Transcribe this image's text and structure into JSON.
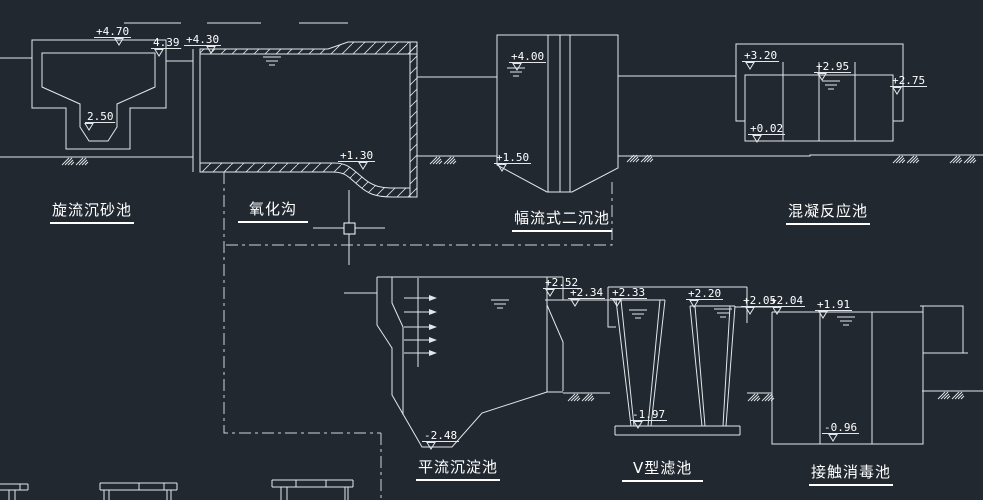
{
  "window": {
    "background_color": "#212830",
    "line_color": "#e3e7ea",
    "text_color": "#ffffff"
  },
  "drawing": {
    "tanks": [
      {
        "id": "grit-chamber",
        "name": "旋流沉砂池"
      },
      {
        "id": "oxidation-ditch",
        "name": "氧化沟"
      },
      {
        "id": "secondary-clarifier",
        "name": "幅流式二沉池"
      },
      {
        "id": "coagulation-tank",
        "name": "混凝反应池"
      },
      {
        "id": "sedimentation-tank",
        "name": "平流沉淀池"
      },
      {
        "id": "v-filter",
        "name": "V型滤池"
      },
      {
        "id": "contact-tank",
        "name": "接触消毒池"
      }
    ],
    "elevation_markers": [
      {
        "label": "+4.70",
        "x": 96,
        "y": 35,
        "tdx": 19
      },
      {
        "label": "4.39",
        "x": 153,
        "y": 46,
        "tdx": 2
      },
      {
        "label": "+4.30",
        "x": 186,
        "y": 43,
        "tdx": 21
      },
      {
        "label": "+1.30",
        "x": 340,
        "y": 159,
        "tdx": 19
      },
      {
        "label": "2.50",
        "x": 87,
        "y": 120,
        "tdx": -2
      },
      {
        "label": "+4.00",
        "x": 511,
        "y": 60,
        "tdx": 2
      },
      {
        "label": "+1.50",
        "x": 496,
        "y": 161,
        "tdx": 2
      },
      {
        "label": "+3.20",
        "x": 744,
        "y": 59,
        "tdx": 2
      },
      {
        "label": "+2.95",
        "x": 816,
        "y": 70,
        "tdx": 2
      },
      {
        "label": "+2.75",
        "x": 892,
        "y": 84,
        "tdx": 1
      },
      {
        "label": "+0.02",
        "x": 750,
        "y": 132,
        "tdx": 3
      },
      {
        "label": "+2.52",
        "x": 545,
        "y": 286,
        "tdx": 1
      },
      {
        "label": "+2.34",
        "x": 570,
        "y": 296,
        "tdx": 1
      },
      {
        "label": "+2.33",
        "x": 612,
        "y": 296,
        "tdx": 1
      },
      {
        "label": "+2.20",
        "x": 688,
        "y": 297,
        "tdx": 2
      },
      {
        "label": "+2.05",
        "x": 743,
        "y": 304,
        "tdx": 3
      },
      {
        "label": "+2.04",
        "x": 770,
        "y": 304,
        "tdx": 3
      },
      {
        "label": "+1.91",
        "x": 817,
        "y": 308,
        "tdx": 2
      },
      {
        "label": "-2.48",
        "x": 424,
        "y": 439,
        "tdx": 3
      },
      {
        "label": "-1.97",
        "x": 632,
        "y": 418,
        "tdx": 2
      },
      {
        "label": "-0.96",
        "x": 824,
        "y": 431,
        "tdx": 5
      }
    ],
    "symbols": {
      "water_level": "water-level-symbol",
      "ground_hatch": "ground-soil-symbol",
      "pipeline": "pipeline-centerline"
    },
    "cursor": {
      "type": "crosshair-with-pickbox"
    }
  }
}
